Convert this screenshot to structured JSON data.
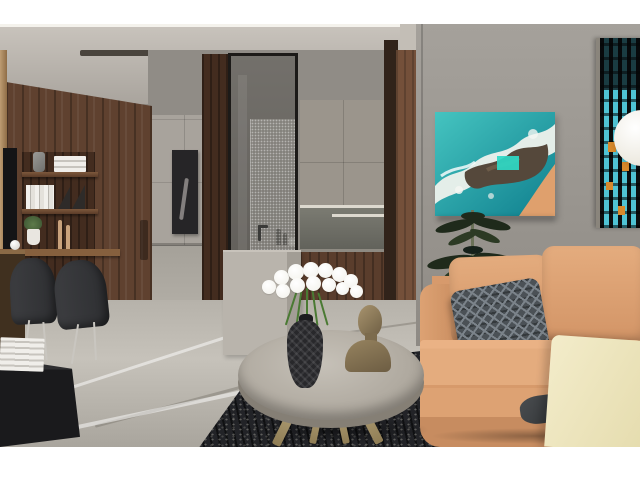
{
  "scene": {
    "kind": "interior-3d-render",
    "room": "modern living room with hallway kitchen view",
    "letterbox": {
      "top_px": 24,
      "bottom_px": 33
    }
  },
  "objects": [
    "letterbox-top",
    "letterbox-bottom",
    "ceiling",
    "cove-light",
    "ceiling-slot",
    "ceiling-spotlight",
    "right-soffit",
    "wood-panel-wall",
    "wood-edge-strip",
    "tv-screen-edge",
    "shelf-niche",
    "wood-shelf",
    "gray-vase",
    "white-book-stack",
    "leaning-books",
    "bookend",
    "small-plant",
    "candlestick",
    "deco-ball",
    "corridor",
    "far-cabinets",
    "corridor-floor",
    "dark-artwork",
    "wood-column",
    "glass-partition",
    "shower-pane",
    "faucet",
    "kitchen-upper-cabinets",
    "under-cabinet-light",
    "backsplash",
    "bottle",
    "cup",
    "kitchen-base-cabinets",
    "kitchen-floor",
    "door-frame",
    "wood-door",
    "kitchen-island",
    "right-wall",
    "ocean-artwork",
    "artwork-shadow",
    "large-plant",
    "pendant-lamp",
    "city-window",
    "marble-floor",
    "floor-vein",
    "dark-rug",
    "dining-chair",
    "chair-leg",
    "desk-wedge",
    "tv-cabinet",
    "books-on-cabinet",
    "sofa",
    "sofa-arm",
    "sofa-cushion",
    "chevron-pillow",
    "dark-throw",
    "cream-armchair",
    "coffee-table",
    "table-leg",
    "table-shadow",
    "black-vase",
    "white-flowers",
    "flower-stem",
    "bronze-bust"
  ],
  "palette": {
    "white_bar": "#ffffff",
    "ceiling_hi": "#c9c4bd",
    "ceiling_lo": "#a9a49d",
    "cove": "#f4f2ec",
    "slot": "#4a443d",
    "soffit": "#c3beb6",
    "wall_right_hi": "#a5a19b",
    "wall_right_lo": "#8e8a84",
    "corridor": "#908c86",
    "cabinet_far": "#a8a39c",
    "corridor_floor": "#b8b4ac",
    "art_dark": "#262527",
    "wood": "#5f412f",
    "wood_dark": "#432c1f",
    "wood_edge": "#bd9c72",
    "ledge": "#86603e",
    "tv": "#141416",
    "books_white": "#f0eeea",
    "chair": "#2e2f32",
    "cabinet_tv": "#1a1a1c",
    "kitchen_cab": "#9b958c",
    "backsplash": "#62625b",
    "underlight": "#ddd9cf",
    "counter_wood": "#5a3d2c",
    "door_frame": "#31231a",
    "door": "#74503a",
    "island": "#b4afa7",
    "floor_hi": "#c6c2ba",
    "floor_lo": "#a9a59d",
    "rug": "#222327",
    "sofa": "#d79a6c",
    "sofa_hi": "#e4ac7e",
    "sofa_lo": "#c78c60",
    "pillow": "#4b5156",
    "pillow_hi": "#7b838a",
    "cream": "#f3ecca",
    "cream_lo": "#e5dcae",
    "table_top": "#b0aaa0",
    "brass": "#c0ae83",
    "brass_lo": "#8f7d55",
    "vase": "#28282b",
    "flower": "#f2f1ea",
    "stem": "#4a7a33",
    "bust_hi": "#a8946e",
    "bust_lo": "#6d5d43",
    "art_teal": "#45c4c0",
    "art_teal_deep": "#0f7f8e",
    "art_foam": "#eef1ec",
    "art_rock": "#55483b",
    "art_sand": "#dfa06d",
    "art_pool": "#2fd9c5",
    "plant_dark": "#1f2a1b",
    "plant_mid": "#2c3a24",
    "window_cyan": "#4fc3d4",
    "window_black": "#0c0e0f",
    "window_orange": "#d8892c",
    "lamp": "#eeebe2"
  }
}
